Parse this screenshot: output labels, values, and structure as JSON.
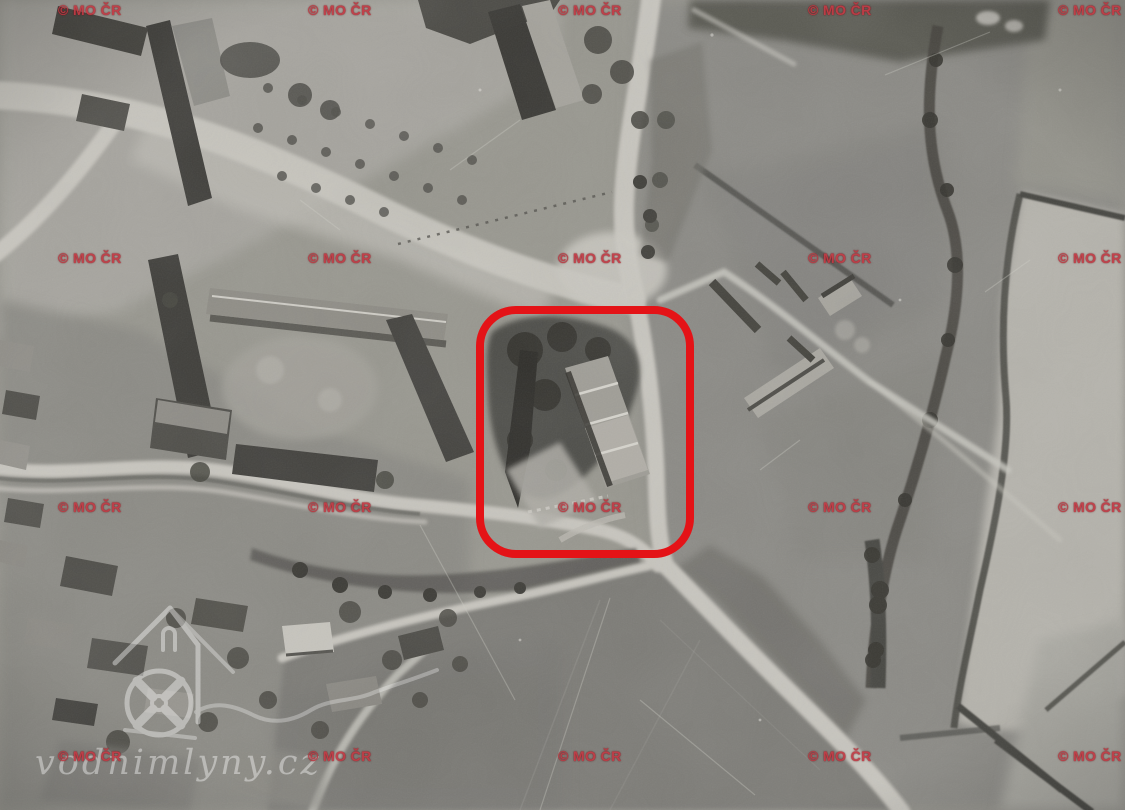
{
  "photo": {
    "description": "Historical black-and-white aerial photograph of a village: farm complex, road junction, fields with hedgerows on the right, large pond at the bottom, water-mill site circled in red",
    "tone": "grayscale"
  },
  "watermarks": {
    "text": "© MO ČR",
    "color": "#c23a44",
    "outline_color": "#70070f",
    "positions": [
      [
        58,
        2
      ],
      [
        308,
        2
      ],
      [
        558,
        2
      ],
      [
        808,
        2
      ],
      [
        1058,
        2
      ],
      [
        58,
        250
      ],
      [
        308,
        250
      ],
      [
        558,
        250
      ],
      [
        808,
        250
      ],
      [
        1058,
        250
      ],
      [
        58,
        499
      ],
      [
        308,
        499
      ],
      [
        558,
        499
      ],
      [
        808,
        499
      ],
      [
        1058,
        499
      ],
      [
        58,
        748
      ],
      [
        308,
        748
      ],
      [
        558,
        748
      ],
      [
        808,
        748
      ],
      [
        1058,
        748
      ]
    ]
  },
  "annotation": {
    "label": "highlighted mill location",
    "shape": "rounded-rectangle",
    "color": "#e41317",
    "x": 476,
    "y": 306,
    "width": 218,
    "height": 252,
    "corner_radius": 40,
    "stroke_width": 8
  },
  "logo": {
    "site_text": "vodnimlyny.cz",
    "icon": "watermill-house-icon",
    "color": "#ffffff",
    "opacity": 0.4
  }
}
